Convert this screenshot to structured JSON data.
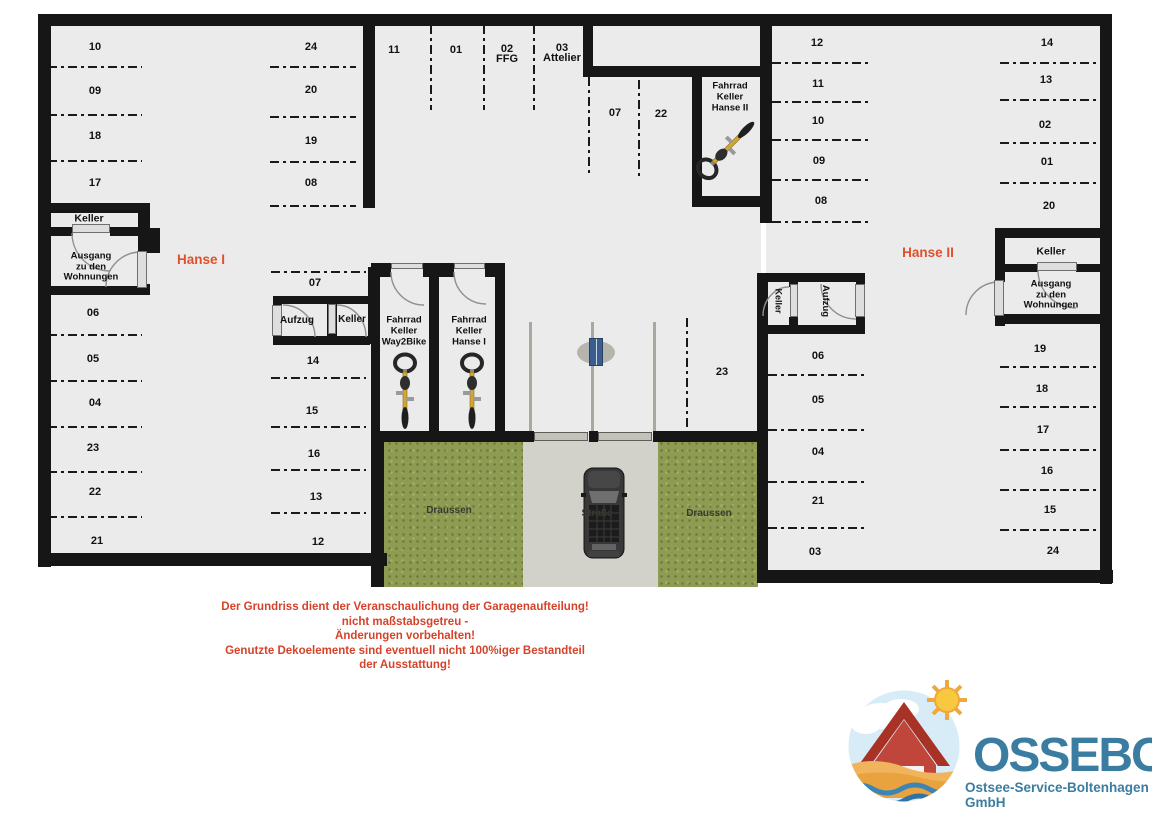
{
  "plan": {
    "stalls": [
      {
        "label": "10",
        "x": 95,
        "y": 47
      },
      {
        "label": "09",
        "x": 95,
        "y": 91
      },
      {
        "label": "18",
        "x": 95,
        "y": 136
      },
      {
        "label": "17",
        "x": 95,
        "y": 183
      },
      {
        "label": "24",
        "x": 311,
        "y": 47
      },
      {
        "label": "20",
        "x": 311,
        "y": 90
      },
      {
        "label": "19",
        "x": 311,
        "y": 141
      },
      {
        "label": "08",
        "x": 311,
        "y": 183
      },
      {
        "label": "11",
        "x": 394,
        "y": 50
      },
      {
        "label": "01",
        "x": 456,
        "y": 50
      },
      {
        "label": "02\nFFG",
        "x": 507,
        "y": 54
      },
      {
        "label": "03\nAttelier",
        "x": 562,
        "y": 53
      },
      {
        "label": "07",
        "x": 615,
        "y": 113
      },
      {
        "label": "22",
        "x": 661,
        "y": 114
      },
      {
        "label": "06",
        "x": 93,
        "y": 313
      },
      {
        "label": "05",
        "x": 93,
        "y": 359
      },
      {
        "label": "04",
        "x": 95,
        "y": 403
      },
      {
        "label": "23",
        "x": 93,
        "y": 448
      },
      {
        "label": "22",
        "x": 95,
        "y": 492
      },
      {
        "label": "21",
        "x": 97,
        "y": 541
      },
      {
        "label": "07",
        "x": 315,
        "y": 283
      },
      {
        "label": "14",
        "x": 313,
        "y": 361
      },
      {
        "label": "15",
        "x": 312,
        "y": 411
      },
      {
        "label": "16",
        "x": 314,
        "y": 454
      },
      {
        "label": "13",
        "x": 316,
        "y": 497
      },
      {
        "label": "12",
        "x": 318,
        "y": 542
      },
      {
        "label": "23",
        "x": 722,
        "y": 372
      },
      {
        "label": "12",
        "x": 817,
        "y": 43
      },
      {
        "label": "11",
        "x": 818,
        "y": 84
      },
      {
        "label": "10",
        "x": 818,
        "y": 121
      },
      {
        "label": "09",
        "x": 819,
        "y": 161
      },
      {
        "label": "08",
        "x": 821,
        "y": 201
      },
      {
        "label": "14",
        "x": 1047,
        "y": 43
      },
      {
        "label": "13",
        "x": 1046,
        "y": 80
      },
      {
        "label": "02",
        "x": 1045,
        "y": 125
      },
      {
        "label": "01",
        "x": 1047,
        "y": 162
      },
      {
        "label": "20",
        "x": 1049,
        "y": 206
      },
      {
        "label": "06",
        "x": 818,
        "y": 356
      },
      {
        "label": "05",
        "x": 818,
        "y": 400
      },
      {
        "label": "04",
        "x": 818,
        "y": 452
      },
      {
        "label": "21",
        "x": 818,
        "y": 501
      },
      {
        "label": "03",
        "x": 815,
        "y": 552
      },
      {
        "label": "19",
        "x": 1040,
        "y": 349
      },
      {
        "label": "18",
        "x": 1042,
        "y": 389
      },
      {
        "label": "17",
        "x": 1043,
        "y": 430
      },
      {
        "label": "16",
        "x": 1047,
        "y": 471
      },
      {
        "label": "15",
        "x": 1050,
        "y": 510
      },
      {
        "label": "24",
        "x": 1053,
        "y": 551
      }
    ],
    "rooms": [
      {
        "id": "keller-left",
        "label": "Keller",
        "x": 89,
        "y": 219,
        "fs": 10.5
      },
      {
        "id": "ausgang-left",
        "label": "Ausgang\nzu den\nWohnungen",
        "x": 91,
        "y": 267,
        "fs": 9.5,
        "lh": 10.5
      },
      {
        "id": "hanse1-label",
        "label": "Hanse I",
        "x": 201,
        "y": 260,
        "fs": 13.5,
        "accent": true
      },
      {
        "id": "aufzug-mid",
        "label": "Aufzug",
        "x": 297,
        "y": 321,
        "fs": 10
      },
      {
        "id": "keller-mid",
        "label": "Keller",
        "x": 352,
        "y": 320,
        "fs": 10
      },
      {
        "id": "fahrrad-keller-way2bike",
        "label": "Fahrrad\nKeller\nWay2Bike",
        "x": 404,
        "y": 331,
        "fs": 9.5,
        "lh": 11
      },
      {
        "id": "fahrrad-keller-hanse1",
        "label": "Fahrrad\nKeller\nHanse I",
        "x": 469,
        "y": 331,
        "fs": 9.5,
        "lh": 11
      },
      {
        "id": "fahrrad-keller-hanse2",
        "label": "Fahrrad\nKeller\nHanse II",
        "x": 730,
        "y": 97,
        "fs": 9.5,
        "lh": 11
      },
      {
        "id": "keller-hanse2-rot",
        "label": "Keller",
        "x": 778,
        "y": 301,
        "fs": 9,
        "rot": true
      },
      {
        "id": "aufzug-hanse2-rot",
        "label": "Aufzug",
        "x": 825,
        "y": 301,
        "fs": 9.5,
        "rot": true
      },
      {
        "id": "hanse2-label",
        "label": "Hanse II",
        "x": 928,
        "y": 253,
        "fs": 13.5,
        "accent": true
      },
      {
        "id": "keller-right",
        "label": "Keller",
        "x": 1051,
        "y": 252,
        "fs": 10.5
      },
      {
        "id": "ausgang-right",
        "label": "Ausgang\nzu den\nWohnungen",
        "x": 1051,
        "y": 295,
        "fs": 9.5,
        "lh": 10.5
      }
    ],
    "outside": [
      {
        "id": "draussen-left",
        "label": "Draussen",
        "x": 449,
        "y": 511
      },
      {
        "id": "strasse",
        "label": "Straße",
        "x": 597,
        "y": 514
      },
      {
        "id": "draussen-right",
        "label": "Draussen",
        "x": 709,
        "y": 514
      }
    ]
  },
  "disclaimer": {
    "lines": [
      "Der Grundriss dient der Veranschaulichung der Garagenaufteilung!",
      "nicht maßstabsgetreu -",
      "Änderungen vorbehalten!",
      "Genutzte Dekoelemente sind eventuell nicht 100%iger Bestandteil",
      "der Ausstattung!"
    ]
  },
  "logo": {
    "name": "OSSEBO",
    "tagline": "Ostsee-Service-Boltenhagen GmbH"
  },
  "colors": {
    "accent": "#e0512a",
    "disclaimer": "#d6422a",
    "logo_text": "#3b7da0",
    "wall": "#161616",
    "floor": "#ebebeb",
    "grass": "#8d9c52",
    "road": "#d2d2ca"
  },
  "icons": {
    "bicycle": "bicycle-top-view-icon",
    "car": "car-top-view-icon",
    "gate": "entrance-gate-icon",
    "sun": "sun-icon",
    "house": "house-icon",
    "cloud": "cloud-icon",
    "waves": "waves-icon"
  }
}
